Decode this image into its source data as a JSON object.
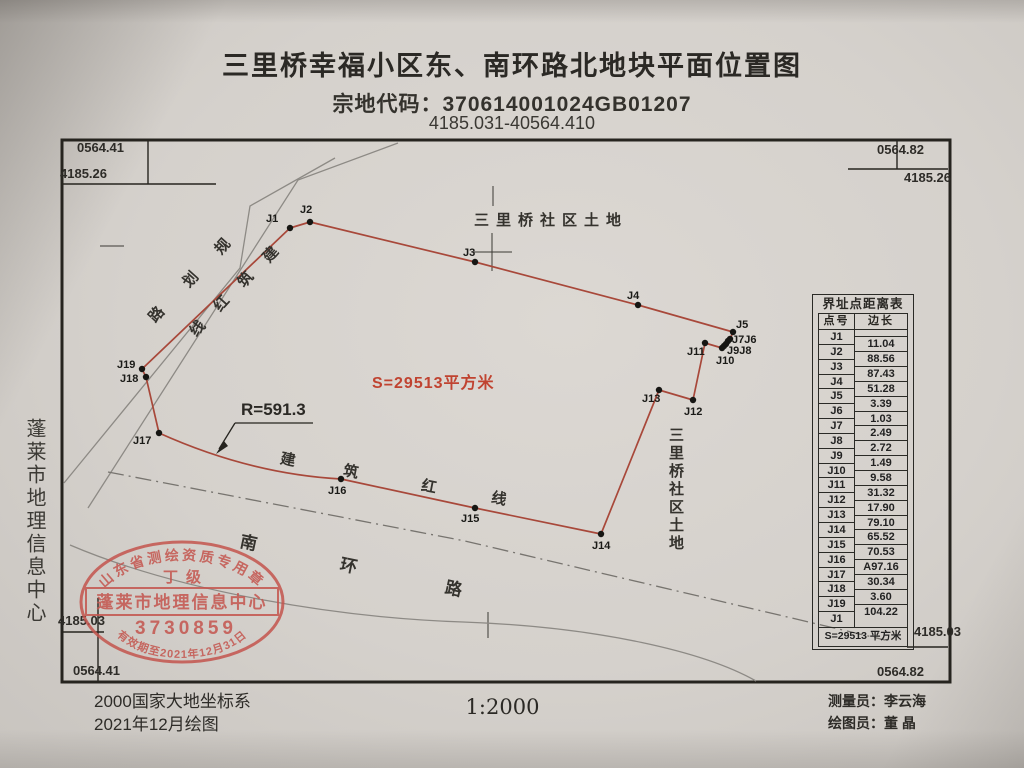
{
  "header": {
    "title": "三里桥幸福小区东、南环路北地块平面位置图",
    "parcel_code": "宗地代码：370614001024GB01207",
    "coord_range": "4185.031-40564.410"
  },
  "corners": {
    "tl_e": "0564.41",
    "tl_n": "4185.26",
    "tr_e": "0564.82",
    "tr_n": "4185.26",
    "bl_n": "4185.03",
    "bl_e": "0564.41",
    "br_n": "4185.03",
    "br_e": "0564.82"
  },
  "map": {
    "north_land": "三里桥社区土地",
    "east_land": "三里桥社区土地",
    "area_label": "S=29513平方米",
    "radius_label": "R=591.3",
    "colors": {
      "boundary_red": "#a8483a",
      "area_text_red": "#c04330",
      "road_gray": "#8d8a85",
      "ink": "#26241f",
      "stamp_red": "#c4554e"
    },
    "boundary_points": [
      {
        "id": "J1",
        "x": 290,
        "y": 228
      },
      {
        "id": "J2",
        "x": 310,
        "y": 222
      },
      {
        "id": "J3",
        "x": 475,
        "y": 262
      },
      {
        "id": "J4",
        "x": 638,
        "y": 305
      },
      {
        "id": "J5",
        "x": 733,
        "y": 332
      },
      {
        "id": "J6",
        "x": 730,
        "y": 339
      },
      {
        "id": "J7",
        "x": 728,
        "y": 341
      },
      {
        "id": "J8",
        "x": 726,
        "y": 344
      },
      {
        "id": "J9",
        "x": 724,
        "y": 346
      },
      {
        "id": "J10",
        "x": 722,
        "y": 348
      },
      {
        "id": "J11",
        "x": 705,
        "y": 343
      },
      {
        "id": "J12",
        "x": 693,
        "y": 400
      },
      {
        "id": "J13",
        "x": 659,
        "y": 390
      },
      {
        "id": "J14",
        "x": 601,
        "y": 534
      },
      {
        "id": "J15",
        "x": 475,
        "y": 508
      },
      {
        "id": "J16",
        "x": 341,
        "y": 479
      },
      {
        "id": "J17",
        "x": 159,
        "y": 433
      },
      {
        "id": "J18",
        "x": 146,
        "y": 377
      },
      {
        "id": "J19",
        "x": 142,
        "y": 369
      }
    ],
    "arc_to_index": 16,
    "arc_control": [
      250,
      474
    ],
    "point_labels": [
      {
        "text": "J1",
        "x": 266,
        "y": 222
      },
      {
        "text": "J2",
        "x": 300,
        "y": 213
      },
      {
        "text": "J3",
        "x": 463,
        "y": 256
      },
      {
        "text": "J4",
        "x": 627,
        "y": 299
      },
      {
        "text": "J5",
        "x": 736,
        "y": 328
      },
      {
        "text": "J7J6",
        "x": 732,
        "y": 343
      },
      {
        "text": "J9J8",
        "x": 727,
        "y": 354
      },
      {
        "text": "J10",
        "x": 716,
        "y": 364
      },
      {
        "text": "J11",
        "x": 687,
        "y": 355
      },
      {
        "text": "J12",
        "x": 684,
        "y": 415
      },
      {
        "text": "J13",
        "x": 642,
        "y": 402
      },
      {
        "text": "J14",
        "x": 592,
        "y": 549
      },
      {
        "text": "J15",
        "x": 461,
        "y": 522
      },
      {
        "text": "J16",
        "x": 328,
        "y": 494
      },
      {
        "text": "J17",
        "x": 133,
        "y": 444
      },
      {
        "text": "J18",
        "x": 120,
        "y": 382
      },
      {
        "text": "J19",
        "x": 117,
        "y": 368
      }
    ],
    "rotated_labels": [
      {
        "name": "planned-road",
        "text": "规划路",
        "rotate": -48,
        "size": 15,
        "positions": [
          [
            222,
            246
          ],
          [
            190,
            279
          ],
          [
            156,
            314
          ]
        ]
      },
      {
        "name": "red-line-nw",
        "text": "建筑红线",
        "rotate": -48,
        "size": 15,
        "positions": [
          [
            270,
            254
          ],
          [
            245,
            279
          ],
          [
            221,
            303
          ],
          [
            197,
            328
          ]
        ]
      },
      {
        "name": "red-line-south",
        "text": "建筑红线",
        "rotate": 11,
        "size": 15,
        "positions": [
          [
            288,
            459
          ],
          [
            351,
            471
          ],
          [
            429,
            486
          ],
          [
            499,
            498
          ]
        ]
      },
      {
        "name": "south-ring-road",
        "text": "南环路",
        "rotate": 12,
        "size": 17,
        "positions": [
          [
            249,
            541
          ],
          [
            349,
            564
          ],
          [
            454,
            587
          ]
        ]
      }
    ]
  },
  "table": {
    "title": "界址点距离表",
    "col_point": "点号",
    "col_length": "边长",
    "points": [
      "J1",
      "J2",
      "J3",
      "J4",
      "J5",
      "J6",
      "J7",
      "J8",
      "J9",
      "J10",
      "J11",
      "J12",
      "J13",
      "J14",
      "J15",
      "J16",
      "J17",
      "J18",
      "J19",
      "J1"
    ],
    "lengths": [
      "11.04",
      "88.56",
      "87.43",
      "51.28",
      "3.39",
      "1.03",
      "2.49",
      "2.72",
      "1.49",
      "9.58",
      "31.32",
      "17.90",
      "79.10",
      "65.52",
      "70.53",
      "A97.16",
      "30.34",
      "3.60",
      "104.22"
    ],
    "area_row": "S=29513 平方米"
  },
  "margin_left": {
    "text": "蓬莱市地理信息中心"
  },
  "stamp": {
    "arc_top": "山东省测绘资质专用章",
    "grade": "丁级",
    "org": "蓬莱市地理信息中心",
    "number": "3730859",
    "arc_bottom": "有效期至2021年12月31日"
  },
  "footer": {
    "coord_system": "2000国家大地坐标系",
    "drawn": "2021年12月绘图",
    "scale": "1:2000",
    "surveyor": "测量员：李云海",
    "draftsman": "绘图员：董 晶"
  }
}
